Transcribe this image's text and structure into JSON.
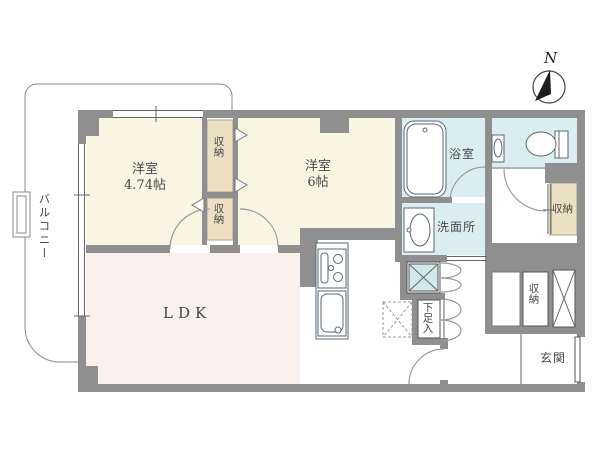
{
  "rooms": {
    "balcony": {
      "label": "バルコニー"
    },
    "western1": {
      "label": "洋室",
      "size": "4.74帖"
    },
    "western2": {
      "label": "洋室",
      "size": "6帖"
    },
    "ldk": {
      "label": "LDK"
    },
    "bathroom": {
      "label": "浴室"
    },
    "washroom": {
      "label": "洗面所"
    },
    "entrance": {
      "label": "玄関"
    }
  },
  "closets": {
    "closet_a": {
      "label": "収納"
    },
    "closet_b": {
      "label": "収納"
    },
    "closet_hall": {
      "label": "収納"
    },
    "closet_entrance": {
      "label": "収納"
    },
    "shoe_cabinet": {
      "label": "下足入"
    }
  },
  "compass": {
    "label": "N"
  },
  "colors": {
    "wall": "#8f8f8f",
    "line": "#666666",
    "room_cream": "#f8f5e2",
    "ldk_pink": "#faf0ee",
    "water_blue": "#daedf1",
    "closet_beige": "#ece0c2",
    "wash_teal": "#cfe9ec"
  }
}
